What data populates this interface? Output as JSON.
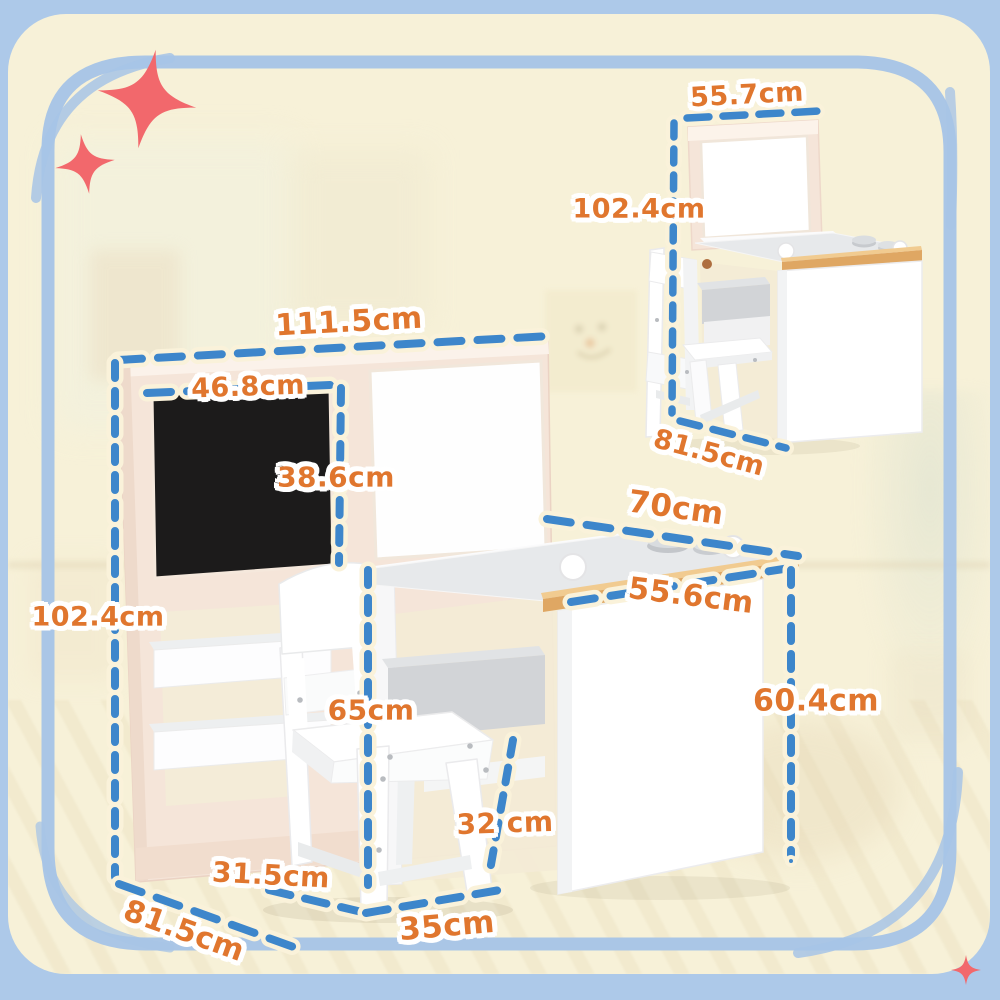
{
  "colors": {
    "background_blue": "#adc9e9",
    "card_cream": "#f7f1d8",
    "hand_drawn_border_blue": "#a7c4e6",
    "dimension_dash_blue": "#3d86cb",
    "dimension_dash_halo": "#faf2da",
    "label_orange": "#e0762e",
    "label_outline": "#ffffff",
    "sparkle_red": "#f2686c",
    "panel_frame_pink": "#f5e5d9",
    "chalkboard_black": "#1c1b1b",
    "wood_trim_tan": "#dfa763",
    "furniture_white": "#ffffff",
    "desktop_gray": "#e7e9eb"
  },
  "icons": {
    "sparkle": "four-point-star",
    "doodle": "smiley-face-picture"
  },
  "dimensions": {
    "main_view": {
      "total_width": "111.5cm",
      "blackboard_width": "46.8cm",
      "blackboard_height": "38.6cm",
      "total_height": "102.4cm",
      "chair_height": "65cm",
      "desktop_width": "70cm",
      "desktop_depth": "55.6cm",
      "desk_height": "60.4cm",
      "seat_height": "32 cm",
      "chair_depth": "31.5cm",
      "total_depth": "81.5cm",
      "chair_width": "35cm"
    },
    "side_view": {
      "width": "55.7cm",
      "height": "102.4cm",
      "depth": "81.5cm"
    }
  }
}
